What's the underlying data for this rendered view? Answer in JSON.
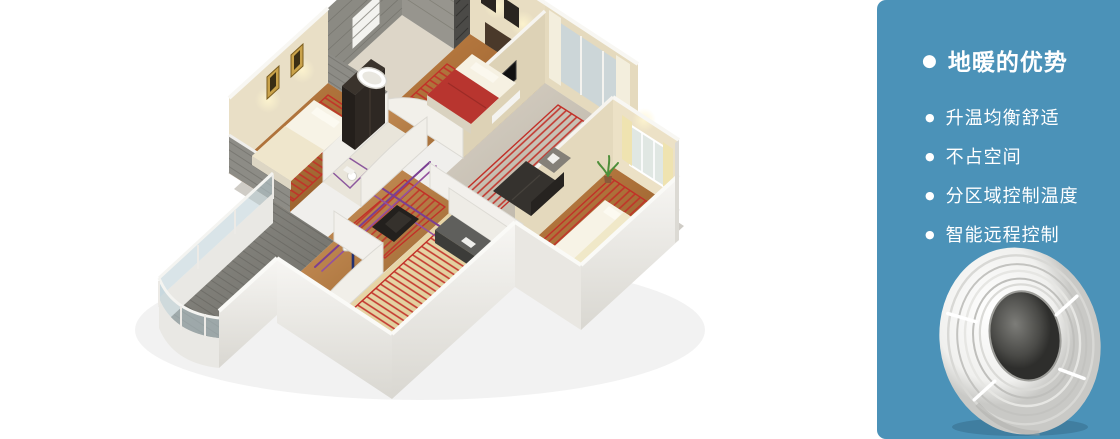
{
  "illustration": {
    "name": "3d-cutaway-apartment-with-underfloor-heating",
    "rooms": [
      "master-bedroom",
      "living-room",
      "right-bedroom",
      "bathroom",
      "left-bedroom",
      "wash-room",
      "dining-hall",
      "kitchen",
      "balcony"
    ],
    "elements": [
      "floor-heating-coils",
      "distribution-pipes",
      "manifold",
      "flow-arrow",
      "furniture"
    ],
    "colors": {
      "coil_red": "#c23028",
      "pipe_purple": "#7b3f92",
      "pipe_navy": "#223070",
      "wood_floor": "#a96a33",
      "stone_gray": "#8d8c86",
      "tile_beige": "#e6d4a8",
      "wall_cream": "#e8ddc2",
      "wall_white": "#f2f0ec"
    }
  },
  "panel": {
    "background_color": "#4b92b8",
    "text_color": "#ffffff",
    "bullet_icon": "●",
    "title": "地暖的优势",
    "items": [
      "升温均衡舒适",
      "不占空间",
      "分区域控制温度",
      "智能远程控制"
    ],
    "product_image": "white-heating-pipe-coil"
  }
}
